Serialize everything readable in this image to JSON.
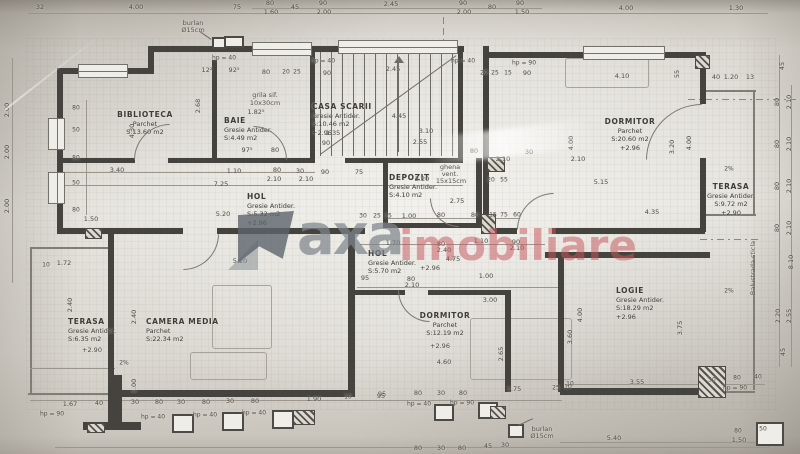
{
  "watermark": {
    "part1": "axa",
    "part2": "imobiliare"
  },
  "colors": {
    "paper": "#e6e4dd",
    "wall": "#45433e",
    "line": "#9a968c",
    "text": "#4c4a44",
    "watermark_gray": "#7e858c",
    "watermark_red": "#c9565d"
  },
  "rooms": [
    {
      "lines": [
        "BIBLIOTECA",
        "Parchet",
        "S:13.60 m2"
      ],
      "x": 145,
      "y": 110,
      "a": "c"
    },
    {
      "lines": [
        "BAIE",
        "Gresie Antider.",
        "S:4.49 m2"
      ],
      "x": 224,
      "y": 116,
      "a": "l"
    },
    {
      "lines": [
        "CASA SCARII",
        "Gresie Antider.",
        "S:10.46 m2",
        "+2.96"
      ],
      "x": 312,
      "y": 102,
      "a": "l"
    },
    {
      "lines": [
        "DORMITOR",
        "Parchet",
        "S:20.60 m2",
        "+2.96"
      ],
      "x": 630,
      "y": 117,
      "a": "c"
    },
    {
      "lines": [
        "TERASA",
        "Gresie Antider.",
        "S:9.72 m2",
        "+2.90"
      ],
      "x": 731,
      "y": 182,
      "a": "c"
    },
    {
      "lines": [
        "HOL",
        "Gresie Antider.",
        "S:5.32 m2",
        "+2.96"
      ],
      "x": 247,
      "y": 192,
      "a": "l"
    },
    {
      "lines": [
        "DEPOZIT",
        "Gresie Antider.",
        "S:4.10 m2"
      ],
      "x": 389,
      "y": 173,
      "a": "l"
    },
    {
      "lines": [
        "HOL",
        "Gresie Antider.",
        "S:5.70 m2"
      ],
      "x": 368,
      "y": 249,
      "a": "l"
    },
    {
      "lines": [
        "TERASA",
        "Gresie Antider.",
        "S:6.35 m2"
      ],
      "x": 68,
      "y": 317,
      "a": "l"
    },
    {
      "lines": [
        "CAMERA MEDIA",
        "Parchet",
        "S:22.34 m2"
      ],
      "x": 146,
      "y": 317,
      "a": "l"
    },
    {
      "lines": [
        "DORMITOR",
        "Parchet",
        "S:12.19 m2"
      ],
      "x": 445,
      "y": 311,
      "a": "c"
    },
    {
      "lines": [
        "LOGIE",
        "Gresie Antider.",
        "S:18.29 m2",
        "+2.96"
      ],
      "x": 616,
      "y": 286,
      "a": "l"
    }
  ],
  "dims": [
    {
      "t": "32",
      "x": 40,
      "y": 7
    },
    {
      "t": "4.00",
      "x": 136,
      "y": 7
    },
    {
      "t": "75",
      "x": 237,
      "y": 7
    },
    {
      "t": "80",
      "x": 270,
      "y": 3
    },
    {
      "t": "1.60",
      "x": 271,
      "y": 12
    },
    {
      "t": "45",
      "x": 295,
      "y": 7
    },
    {
      "t": "90",
      "x": 323,
      "y": 3
    },
    {
      "t": "2.00",
      "x": 324,
      "y": 12
    },
    {
      "t": "2.45",
      "x": 391,
      "y": 4
    },
    {
      "t": "90",
      "x": 463,
      "y": 3
    },
    {
      "t": "2.00",
      "x": 464,
      "y": 12
    },
    {
      "t": "80",
      "x": 492,
      "y": 7
    },
    {
      "t": "90",
      "x": 520,
      "y": 3
    },
    {
      "t": "1.50",
      "x": 522,
      "y": 12
    },
    {
      "t": "4.00",
      "x": 626,
      "y": 8
    },
    {
      "t": "1.30",
      "x": 736,
      "y": 8
    },
    {
      "t": "hp = 40",
      "x": 224,
      "y": 58,
      "s": 6
    },
    {
      "t": "12²",
      "x": 207,
      "y": 70
    },
    {
      "t": "92⁵",
      "x": 234,
      "y": 70
    },
    {
      "t": "80",
      "x": 266,
      "y": 72
    },
    {
      "t": "20",
      "x": 286,
      "y": 72,
      "s": 6
    },
    {
      "t": "25",
      "x": 297,
      "y": 72,
      "s": 6
    },
    {
      "t": "hp = 40",
      "x": 323,
      "y": 61,
      "s": 6
    },
    {
      "t": "90",
      "x": 327,
      "y": 73
    },
    {
      "t": "2.45",
      "x": 393,
      "y": 69
    },
    {
      "t": "hp = 40",
      "x": 463,
      "y": 61,
      "s": 6
    },
    {
      "t": "20",
      "x": 484,
      "y": 73,
      "s": 6
    },
    {
      "t": "25",
      "x": 495,
      "y": 73,
      "s": 6
    },
    {
      "t": "15",
      "x": 508,
      "y": 73,
      "s": 6
    },
    {
      "t": "90",
      "x": 527,
      "y": 73
    },
    {
      "t": "hp = 90",
      "x": 524,
      "y": 63,
      "s": 6
    },
    {
      "t": "4.10",
      "x": 622,
      "y": 76
    },
    {
      "t": "55",
      "x": 677,
      "y": 74,
      "r": 1
    },
    {
      "t": "40",
      "x": 716,
      "y": 77
    },
    {
      "t": "1.20",
      "x": 731,
      "y": 77
    },
    {
      "t": "13",
      "x": 750,
      "y": 77
    },
    {
      "t": "2.00",
      "x": 7,
      "y": 110,
      "r": 1
    },
    {
      "t": "2.00",
      "x": 7,
      "y": 152,
      "r": 1
    },
    {
      "t": "2.00",
      "x": 7,
      "y": 206,
      "r": 1
    },
    {
      "t": "80",
      "x": 76,
      "y": 108,
      "s": 6
    },
    {
      "t": "50",
      "x": 76,
      "y": 130,
      "s": 6
    },
    {
      "t": "80",
      "x": 76,
      "y": 158,
      "s": 6
    },
    {
      "t": "50",
      "x": 76,
      "y": 183,
      "s": 6
    },
    {
      "t": "80",
      "x": 76,
      "y": 210,
      "s": 6
    },
    {
      "t": "1.50",
      "x": 91,
      "y": 219
    },
    {
      "t": "1.72",
      "x": 64,
      "y": 263
    },
    {
      "t": "10",
      "x": 46,
      "y": 265,
      "s": 6
    },
    {
      "t": "2.40",
      "x": 70,
      "y": 305,
      "r": 1
    },
    {
      "t": "4.30",
      "x": 132,
      "y": 131,
      "r": 1
    },
    {
      "t": "2.68",
      "x": 198,
      "y": 106,
      "r": 1
    },
    {
      "t": "1.82⁵",
      "x": 256,
      "y": 112
    },
    {
      "t": "97⁵",
      "x": 247,
      "y": 150
    },
    {
      "t": "80",
      "x": 275,
      "y": 150
    },
    {
      "t": "3.40",
      "x": 117,
      "y": 170
    },
    {
      "t": "1.10",
      "x": 234,
      "y": 171
    },
    {
      "t": "80",
      "x": 277,
      "y": 170
    },
    {
      "t": "30",
      "x": 300,
      "y": 171
    },
    {
      "t": "90",
      "x": 325,
      "y": 172
    },
    {
      "t": "75",
      "x": 359,
      "y": 172
    },
    {
      "t": "7.25",
      "x": 221,
      "y": 184
    },
    {
      "t": "2.10",
      "x": 274,
      "y": 179
    },
    {
      "t": "2.10",
      "x": 306,
      "y": 179
    },
    {
      "t": "4.45",
      "x": 399,
      "y": 116
    },
    {
      "t": "3.10",
      "x": 426,
      "y": 131
    },
    {
      "t": "2.55",
      "x": 420,
      "y": 142
    },
    {
      "t": "1.35",
      "x": 333,
      "y": 133
    },
    {
      "t": "90",
      "x": 326,
      "y": 143
    },
    {
      "t": "2.20",
      "x": 422,
      "y": 179
    },
    {
      "t": "20",
      "x": 491,
      "y": 180,
      "s": 6
    },
    {
      "t": "55",
      "x": 504,
      "y": 180,
      "s": 6
    },
    {
      "t": "2.75",
      "x": 457,
      "y": 201
    },
    {
      "t": "15",
      "x": 388,
      "y": 216,
      "s": 6
    },
    {
      "t": "1.00",
      "x": 409,
      "y": 216
    },
    {
      "t": "80",
      "x": 441,
      "y": 215
    },
    {
      "t": "80",
      "x": 475,
      "y": 215
    },
    {
      "t": "15",
      "x": 493,
      "y": 215,
      "s": 6
    },
    {
      "t": "75",
      "x": 504,
      "y": 215,
      "s": 6
    },
    {
      "t": "60",
      "x": 517,
      "y": 215,
      "s": 6
    },
    {
      "t": "80",
      "x": 474,
      "y": 151
    },
    {
      "t": "30",
      "x": 529,
      "y": 152
    },
    {
      "t": "2.10",
      "x": 503,
      "y": 159
    },
    {
      "t": "2.10",
      "x": 578,
      "y": 159
    },
    {
      "t": "4.00",
      "x": 571,
      "y": 143,
      "r": 1
    },
    {
      "t": "3.20",
      "x": 672,
      "y": 147,
      "r": 1
    },
    {
      "t": "4.00",
      "x": 689,
      "y": 143,
      "r": 1
    },
    {
      "t": "5.15",
      "x": 601,
      "y": 182
    },
    {
      "t": "4.35",
      "x": 652,
      "y": 212
    },
    {
      "t": "45",
      "x": 782,
      "y": 66,
      "r": 1
    },
    {
      "t": "80",
      "x": 777,
      "y": 102,
      "r": 1
    },
    {
      "t": "2.10",
      "x": 789,
      "y": 102,
      "r": 1
    },
    {
      "t": "80",
      "x": 777,
      "y": 144,
      "r": 1
    },
    {
      "t": "2.10",
      "x": 789,
      "y": 144,
      "r": 1
    },
    {
      "t": "80",
      "x": 777,
      "y": 186,
      "r": 1
    },
    {
      "t": "2.10",
      "x": 789,
      "y": 186,
      "r": 1
    },
    {
      "t": "80",
      "x": 777,
      "y": 228,
      "r": 1
    },
    {
      "t": "2.10",
      "x": 789,
      "y": 228,
      "r": 1
    },
    {
      "t": "8.10",
      "x": 791,
      "y": 262,
      "r": 1
    },
    {
      "t": "2.20",
      "x": 778,
      "y": 316,
      "r": 1
    },
    {
      "t": "2.55",
      "x": 789,
      "y": 316,
      "r": 1
    },
    {
      "t": "45",
      "x": 783,
      "y": 352,
      "r": 1
    },
    {
      "t": "5.20",
      "x": 223,
      "y": 214
    },
    {
      "t": "30",
      "x": 363,
      "y": 216,
      "s": 6
    },
    {
      "t": "25",
      "x": 377,
      "y": 216,
      "s": 6
    },
    {
      "t": "1.70",
      "x": 393,
      "y": 243
    },
    {
      "t": "80",
      "x": 441,
      "y": 244
    },
    {
      "t": "1.10",
      "x": 481,
      "y": 241
    },
    {
      "t": "90",
      "x": 516,
      "y": 242
    },
    {
      "t": "2.40",
      "x": 444,
      "y": 250
    },
    {
      "t": "2.10",
      "x": 517,
      "y": 248
    },
    {
      "t": "4.75",
      "x": 453,
      "y": 259
    },
    {
      "t": "+2.96",
      "x": 430,
      "y": 268
    },
    {
      "t": "95",
      "x": 365,
      "y": 278
    },
    {
      "t": "80",
      "x": 411,
      "y": 279
    },
    {
      "t": "2.10",
      "x": 412,
      "y": 285
    },
    {
      "t": "1.00",
      "x": 486,
      "y": 276
    },
    {
      "t": "3.00",
      "x": 490,
      "y": 300
    },
    {
      "t": "5.20",
      "x": 240,
      "y": 261
    },
    {
      "t": "2.65",
      "x": 501,
      "y": 354,
      "r": 1
    },
    {
      "t": "4.60",
      "x": 444,
      "y": 362
    },
    {
      "t": "1.75",
      "x": 514,
      "y": 389
    },
    {
      "t": "25",
      "x": 556,
      "y": 388,
      "s": 6
    },
    {
      "t": "10",
      "x": 568,
      "y": 387,
      "s": 6
    },
    {
      "t": "95",
      "x": 382,
      "y": 394
    },
    {
      "t": "80",
      "x": 418,
      "y": 393
    },
    {
      "t": "30",
      "x": 441,
      "y": 393
    },
    {
      "t": "80",
      "x": 463,
      "y": 393
    },
    {
      "t": "hp = 40",
      "x": 419,
      "y": 404,
      "s": 6
    },
    {
      "t": "hp = 90",
      "x": 462,
      "y": 403,
      "s": 6
    },
    {
      "t": "+2.96",
      "x": 440,
      "y": 346
    },
    {
      "t": "2.40",
      "x": 134,
      "y": 317,
      "r": 1
    },
    {
      "t": "1.00",
      "x": 134,
      "y": 386,
      "r": 1
    },
    {
      "t": "+2.90",
      "x": 92,
      "y": 350
    },
    {
      "t": "2%",
      "x": 124,
      "y": 363,
      "s": 6
    },
    {
      "t": "1.67",
      "x": 70,
      "y": 404
    },
    {
      "t": "40",
      "x": 99,
      "y": 403
    },
    {
      "t": "30",
      "x": 135,
      "y": 402
    },
    {
      "t": "80",
      "x": 159,
      "y": 402
    },
    {
      "t": "30",
      "x": 181,
      "y": 402
    },
    {
      "t": "80",
      "x": 206,
      "y": 402
    },
    {
      "t": "30",
      "x": 230,
      "y": 401
    },
    {
      "t": "80",
      "x": 255,
      "y": 401
    },
    {
      "t": "1.90",
      "x": 314,
      "y": 399
    },
    {
      "t": "10",
      "x": 348,
      "y": 397,
      "s": 6
    },
    {
      "t": "95",
      "x": 381,
      "y": 396
    },
    {
      "t": "hp = 90",
      "x": 52,
      "y": 414,
      "s": 6
    },
    {
      "t": "hp = 40",
      "x": 153,
      "y": 417,
      "s": 6
    },
    {
      "t": "hp = 40",
      "x": 205,
      "y": 415,
      "s": 6
    },
    {
      "t": "hp = 40",
      "x": 254,
      "y": 413,
      "s": 6
    },
    {
      "t": "2%",
      "x": 729,
      "y": 169,
      "s": 6
    },
    {
      "t": "2%",
      "x": 729,
      "y": 291,
      "s": 6
    },
    {
      "t": "4.00",
      "x": 580,
      "y": 315,
      "r": 1
    },
    {
      "t": "3.60",
      "x": 570,
      "y": 337,
      "r": 1
    },
    {
      "t": "3.75",
      "x": 680,
      "y": 328,
      "r": 1
    },
    {
      "t": "3.55",
      "x": 637,
      "y": 382
    },
    {
      "t": "10",
      "x": 570,
      "y": 384,
      "s": 6
    },
    {
      "t": "50",
      "x": 712,
      "y": 380,
      "s": 6
    },
    {
      "t": "80",
      "x": 737,
      "y": 378,
      "s": 6
    },
    {
      "t": "40",
      "x": 758,
      "y": 377,
      "s": 6
    },
    {
      "t": "hp = 90",
      "x": 735,
      "y": 388,
      "s": 6
    },
    {
      "t": "5.40",
      "x": 614,
      "y": 438
    },
    {
      "t": "80",
      "x": 738,
      "y": 431,
      "s": 6
    },
    {
      "t": "1.50",
      "x": 739,
      "y": 440
    },
    {
      "t": "50",
      "x": 763,
      "y": 429,
      "s": 6
    },
    {
      "t": "80",
      "x": 418,
      "y": 448
    },
    {
      "t": "30",
      "x": 441,
      "y": 448
    },
    {
      "t": "80",
      "x": 462,
      "y": 448
    },
    {
      "t": "45",
      "x": 488,
      "y": 446
    },
    {
      "t": "30",
      "x": 505,
      "y": 445
    }
  ],
  "annotations": [
    {
      "t": "burlan",
      "x": 193,
      "y": 23
    },
    {
      "t": "Ø15cm",
      "x": 193,
      "y": 30
    },
    {
      "t": "burlan",
      "x": 542,
      "y": 429
    },
    {
      "t": "Ø15cm",
      "x": 542,
      "y": 436
    },
    {
      "t": "ghena",
      "x": 450,
      "y": 167
    },
    {
      "t": "vent.",
      "x": 450,
      "y": 174
    },
    {
      "t": "15x15cm",
      "x": 451,
      "y": 181
    },
    {
      "t": "grila sif.",
      "x": 265,
      "y": 95
    },
    {
      "t": "10x30cm",
      "x": 265,
      "y": 103
    },
    {
      "t": "Balustrada sticla",
      "x": 753,
      "y": 268,
      "r": 1
    }
  ]
}
